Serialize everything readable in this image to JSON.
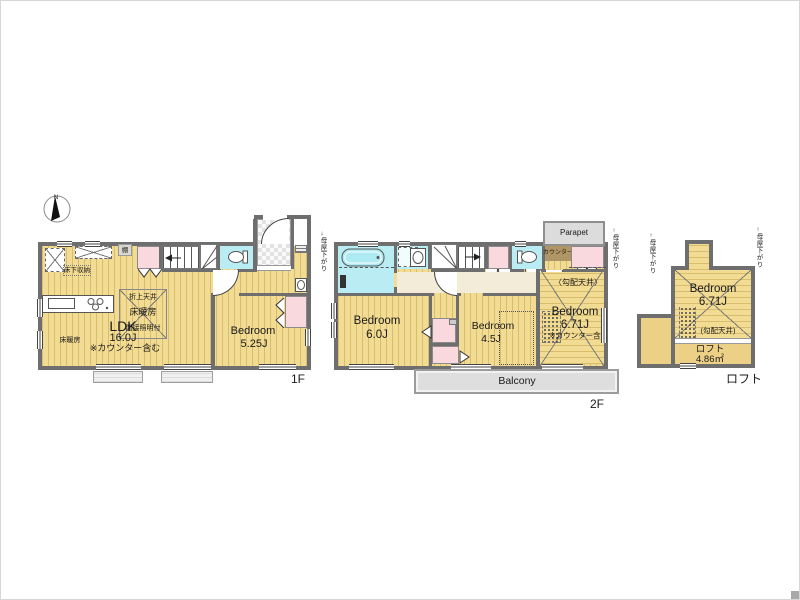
{
  "colors": {
    "flooring_yellow": "#f2db93",
    "storage_pink": "#f9d9de",
    "wet_area_cyan": "#b9edf3",
    "balcony_gray": "#dedede",
    "wall_gray": "#6e6e6e",
    "counter_brown": "#b09566"
  },
  "compass": {
    "north": "N"
  },
  "floor1": {
    "floor_label": "1F",
    "shelf": "棚",
    "underfloor_storage": "床下収納",
    "floor_heating": "床暖房",
    "ldk": {
      "name": "LDK",
      "size": "16.0J",
      "note": "※カウンター含む"
    },
    "ceiling_feature": {
      "line1": "折上天井",
      "line2": "床暖房",
      "line3": "間接照明付"
    },
    "bedroom": {
      "name": "Bedroom",
      "size": "5.25J"
    }
  },
  "floor2": {
    "floor_label": "2F",
    "moya_sagari_left": "母屋下がり",
    "moya_sagari_right": "母屋下がり",
    "arrow_down": "↓",
    "arrow_up": "↑",
    "parapet": "Parapet",
    "counter": "カウンター",
    "sloped_ceiling": "〈勾配天井〉",
    "bedroom_60": {
      "name": "Bedroom",
      "size": "6.0J"
    },
    "bedroom_45": {
      "name": "Bedroom",
      "size": "4.5J"
    },
    "bedroom_671": {
      "name": "Bedroom",
      "size": "6.71J",
      "note": "※カウンター含"
    },
    "balcony": "Balcony"
  },
  "loft": {
    "floor_label": "ロフト",
    "moya_sagari_left": "母屋下がり",
    "moya_sagari_right": "母屋下がり",
    "arrow_up": "↑",
    "bedroom": {
      "name": "Bedroom",
      "size": "6.71J"
    },
    "sloped_ceiling": "(勾配天井)",
    "loft_space": {
      "name": "ロフト",
      "size": "4.86㎡"
    }
  }
}
